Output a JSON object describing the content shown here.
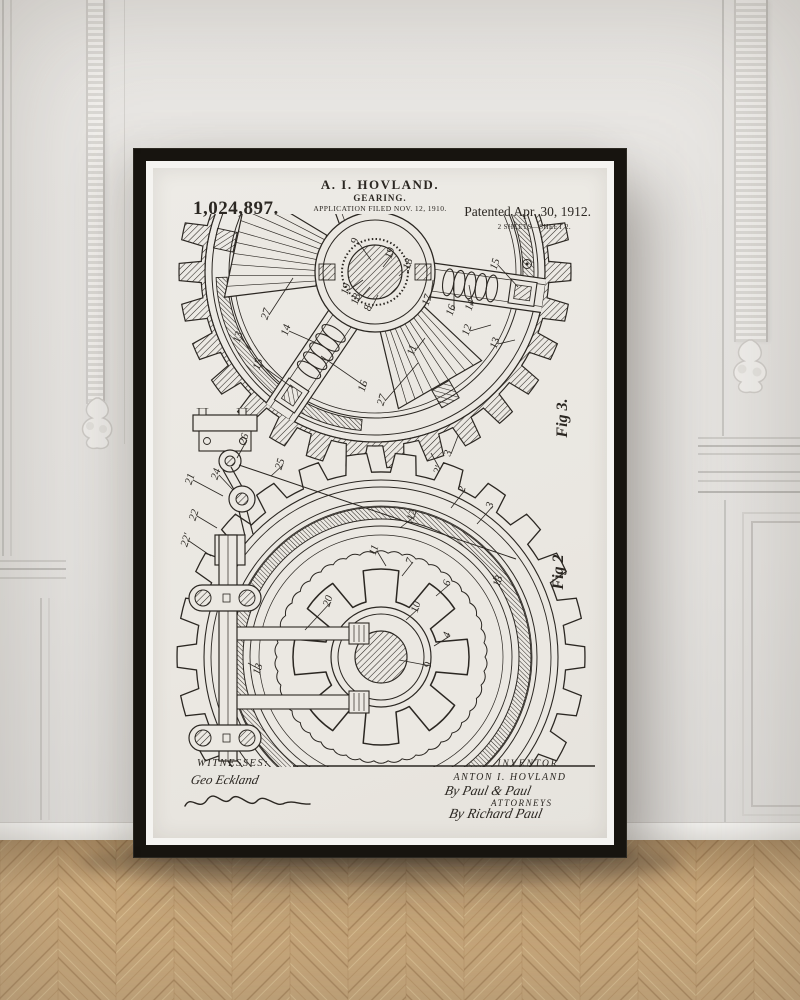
{
  "scene": {
    "wall_color": "#e8e6e3",
    "floor_color": "#c9a87b",
    "frame_color": "#17140f",
    "paper_color": "#ebe8e2",
    "ink_color": "#2b2722"
  },
  "poster": {
    "header": {
      "inventor_line": "A. I. HOVLAND.",
      "title": "GEARING.",
      "application": "APPLICATION FILED NOV. 12, 1910.",
      "patent_number": "1,024,897.",
      "patented": "Patented Apr. 30, 1912.",
      "sheet": "2 SHEETS—SHEET 2."
    },
    "figures": [
      {
        "id": "fig3",
        "caption": "Fig 3.",
        "labels": [
          {
            "t": "9",
            "x": 205,
            "y": 74,
            "lx": 218,
            "ly": 92
          },
          {
            "t": "19",
            "x": 240,
            "y": 86,
            "lx": 230,
            "ly": 99
          },
          {
            "t": "18",
            "x": 258,
            "y": 97,
            "lx": 246,
            "ly": 108
          },
          {
            "t": "15",
            "x": 345,
            "y": 97,
            "lx": 365,
            "ly": 119
          },
          {
            "t": "14",
            "x": 320,
            "y": 138,
            "lx": 316,
            "ly": 117
          },
          {
            "t": "16",
            "x": 301,
            "y": 143,
            "lx": 301,
            "ly": 115
          },
          {
            "t": "17",
            "x": 277,
            "y": 133,
            "lx": 280,
            "ly": 112
          },
          {
            "t": "19",
            "x": 196,
            "y": 122,
            "lx": 210,
            "ly": 112
          },
          {
            "t": "18",
            "x": 206,
            "y": 132,
            "lx": 217,
            "ly": 119
          },
          {
            "t": "8",
            "x": 218,
            "y": 141,
            "lx": 225,
            "ly": 127
          },
          {
            "t": "27",
            "x": 116,
            "y": 147,
            "lx": 140,
            "ly": 110
          },
          {
            "t": "14",
            "x": 136,
            "y": 163,
            "lx": 170,
            "ly": 178
          },
          {
            "t": "15",
            "x": 108,
            "y": 197,
            "lx": 140,
            "ly": 220
          },
          {
            "t": "16",
            "x": 213,
            "y": 219,
            "lx": 168,
            "ly": 188
          },
          {
            "t": "27",
            "x": 232,
            "y": 233,
            "lx": 265,
            "ly": 195
          },
          {
            "t": "11",
            "x": 262,
            "y": 183,
            "lx": 272,
            "ly": 170
          },
          {
            "t": "12",
            "x": 317,
            "y": 163,
            "lx": 338,
            "ly": 157
          },
          {
            "t": "13",
            "x": 345,
            "y": 176,
            "lx": 362,
            "ly": 172
          },
          {
            "t": "13",
            "x": 88,
            "y": 170,
            "lx": 98,
            "ly": 182
          },
          {
            "t": "3",
            "x": 298,
            "y": 286,
            "lx": 305,
            "ly": 268
          },
          {
            "t": "2'",
            "x": 288,
            "y": 303,
            "lx": 278,
            "ly": 285
          }
        ]
      },
      {
        "id": "fig2",
        "caption": "Fig 2",
        "labels": [
          {
            "t": "26",
            "x": 94,
            "y": 272,
            "lx": 84,
            "ly": 290
          },
          {
            "t": "25",
            "x": 130,
            "y": 297,
            "lx": 118,
            "ly": 308
          },
          {
            "t": "24",
            "x": 66,
            "y": 307,
            "lx": 80,
            "ly": 322
          },
          {
            "t": "21",
            "x": 40,
            "y": 312,
            "lx": 70,
            "ly": 328
          },
          {
            "t": "22",
            "x": 44,
            "y": 348,
            "lx": 64,
            "ly": 360
          },
          {
            "t": "22'",
            "x": 36,
            "y": 373,
            "lx": 58,
            "ly": 388
          },
          {
            "t": "20",
            "x": 178,
            "y": 434,
            "lx": 152,
            "ly": 462
          },
          {
            "t": "13",
            "x": 108,
            "y": 502,
            "lx": 95,
            "ly": 495
          },
          {
            "t": "12",
            "x": 262,
            "y": 348,
            "lx": 247,
            "ly": 360
          },
          {
            "t": "2",
            "x": 312,
            "y": 322,
            "lx": 298,
            "ly": 340
          },
          {
            "t": "3",
            "x": 340,
            "y": 338,
            "lx": 324,
            "ly": 356
          },
          {
            "t": "13",
            "x": 348,
            "y": 414,
            "lx": 340,
            "ly": 410
          },
          {
            "t": "11",
            "x": 224,
            "y": 383,
            "lx": 233,
            "ly": 398
          },
          {
            "t": "7",
            "x": 260,
            "y": 394,
            "lx": 249,
            "ly": 408
          },
          {
            "t": "6",
            "x": 297,
            "y": 416,
            "lx": 283,
            "ly": 428
          },
          {
            "t": "10",
            "x": 266,
            "y": 440,
            "lx": 253,
            "ly": 452
          },
          {
            "t": "4",
            "x": 297,
            "y": 468,
            "lx": 281,
            "ly": 478
          },
          {
            "t": "9",
            "x": 278,
            "y": 498,
            "lx": 246,
            "ly": 492
          }
        ]
      }
    ],
    "footer": {
      "witnesses_heading": "WITNESSES:",
      "witness_signature_1": "Geo Eckland",
      "witness_signature_2": "illegible cursive signature",
      "inventor_heading": "INVENTOR",
      "inventor_name": "ANTON I. HOVLAND",
      "by_line": "By Paul & Paul",
      "attorneys_label": "ATTORNEYS",
      "attorney_signature": "By Richard Paul"
    }
  }
}
